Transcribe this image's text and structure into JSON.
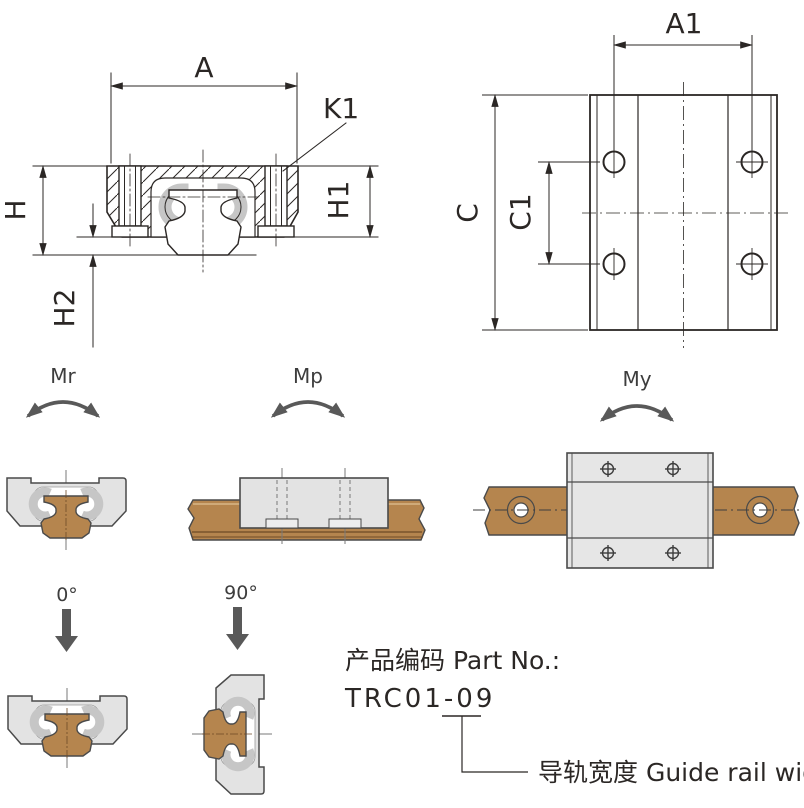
{
  "front_view": {
    "a": "A",
    "k1": "K1",
    "h": "H",
    "h1": "H1",
    "h2": "H2"
  },
  "plan_view": {
    "a1": "A1",
    "c": "C",
    "c1": "C1"
  },
  "moment_labels": {
    "mr": "Mr",
    "mp": "Mp",
    "my": "My"
  },
  "orientation_labels": {
    "deg0": "0°",
    "deg90": "90°"
  },
  "part_info": {
    "label": "产品编码 Part No.:",
    "number": "TRC01-09",
    "callout": "导轨宽度 Guide rail width"
  },
  "colors": {
    "line": "#2b2725",
    "outline_gray": "#4a4a4a",
    "rail_brown": "#b5854e",
    "rail_brown_dark": "#6e4a26",
    "block_gray": "#e3e3e3",
    "bearing_gray": "#c6c6c6",
    "arrow_gray": "#595959"
  }
}
